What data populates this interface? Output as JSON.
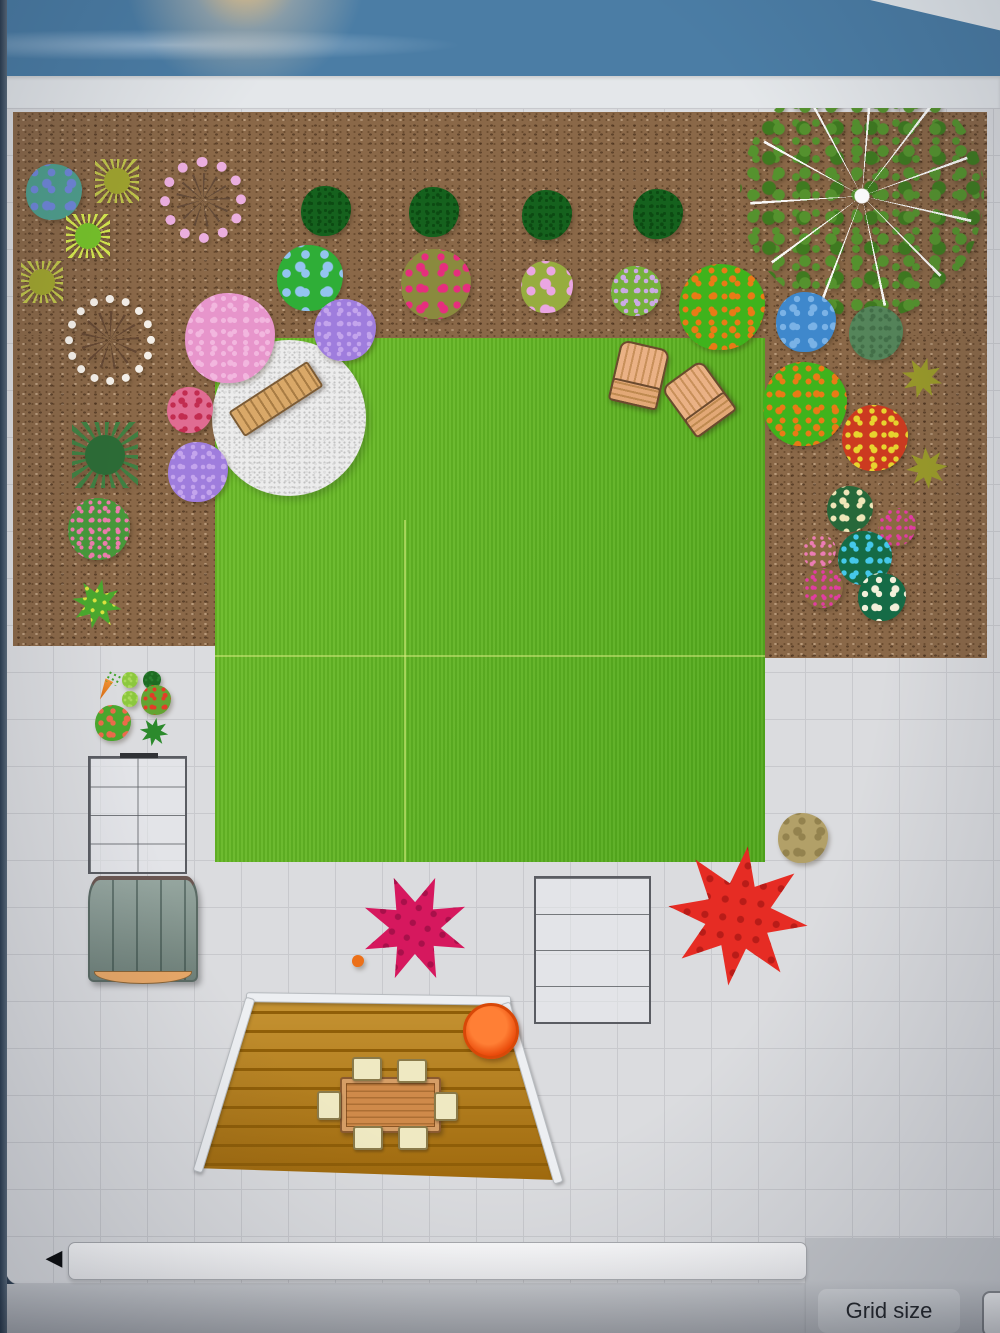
{
  "footer": {
    "grid_size_label": "Grid size",
    "scroll_left_arrow": "◀"
  },
  "garden": {
    "colors": {
      "band_blue": "#4b7da5",
      "band_white": "#e4e7ea",
      "canvas": "#dbdcdf",
      "grid_line": "#c8c9cd",
      "mulch": "#8a6848",
      "lawn": "#5bb51f",
      "gravel": "#ececec",
      "deck": "#b4790f",
      "deck_stripe": "#8f5e08",
      "wood": "#d9a868",
      "chair_cream": "#efe9c2",
      "shed": "#7e928a",
      "bowl": "#f05010",
      "bottom_bar": "#c6c8cc"
    },
    "plants": [
      {
        "name": "blue-berry-bush",
        "shape": "blob",
        "x": 54,
        "y": 192,
        "r": 28,
        "base": "#4f9e8c",
        "dot": "#6f86d8",
        "ds": 17
      },
      {
        "name": "olive-spiky-plant-1",
        "shape": "spike",
        "x": 117,
        "y": 181,
        "r": 22,
        "base": "#a0a42e",
        "tip": "#c0c44a"
      },
      {
        "name": "pink-blossom-wreath",
        "shape": "ring",
        "x": 203,
        "y": 200,
        "r": 52,
        "base": "#5f4736",
        "dot": "#eaaede",
        "bw": 10
      },
      {
        "name": "boxwood-bush-1",
        "shape": "blob",
        "x": 326,
        "y": 211,
        "r": 25,
        "base": "#15611d",
        "dot": "#0c4a12",
        "ds": 7
      },
      {
        "name": "boxwood-bush-2",
        "shape": "blob",
        "x": 434,
        "y": 212,
        "r": 25,
        "base": "#15611d",
        "dot": "#0c4a12",
        "ds": 7
      },
      {
        "name": "boxwood-bush-3",
        "shape": "blob",
        "x": 547,
        "y": 215,
        "r": 25,
        "base": "#15611d",
        "dot": "#0c4a12",
        "ds": 7
      },
      {
        "name": "boxwood-bush-4",
        "shape": "blob",
        "x": 658,
        "y": 214,
        "r": 25,
        "base": "#15611d",
        "dot": "#0c4a12",
        "ds": 7
      },
      {
        "name": "large-tree",
        "shape": "tree",
        "x": 862,
        "y": 196,
        "r": 122,
        "base": "#55922e",
        "dot": "#3f7a20"
      },
      {
        "name": "green-spiky-plant",
        "shape": "spike",
        "x": 88,
        "y": 236,
        "r": 22,
        "base": "#76c22a",
        "tip": "#d6e84e"
      },
      {
        "name": "olive-spiky-plant-2",
        "shape": "spike",
        "x": 42,
        "y": 282,
        "r": 21,
        "base": "#a0a42e",
        "tip": "#c0c44a"
      },
      {
        "name": "blue-flower-plant",
        "shape": "blob",
        "x": 310,
        "y": 278,
        "r": 33,
        "base": "#2fae37",
        "dot": "#93c4ef",
        "ds": 19
      },
      {
        "name": "magenta-flower-plant",
        "shape": "blob",
        "x": 436,
        "y": 284,
        "r": 35,
        "base": "#8a8a3e",
        "dot": "#e62e7e",
        "ds": 16
      },
      {
        "name": "pink-peony-cluster",
        "shape": "blob",
        "x": 547,
        "y": 287,
        "r": 26,
        "base": "#97ad3f",
        "dot": "#eaa6e2",
        "ds": 20
      },
      {
        "name": "lavender-hydrangea",
        "shape": "blob",
        "x": 636,
        "y": 291,
        "r": 25,
        "base": "#76b13a",
        "dot": "#cbaae4",
        "ds": 10
      },
      {
        "name": "orange-berry-bush-1",
        "shape": "blob",
        "x": 722,
        "y": 307,
        "r": 43,
        "base": "#3fb31c",
        "dot": "#e97a16",
        "ds": 13
      },
      {
        "name": "white-blossom-wreath",
        "shape": "ring",
        "x": 110,
        "y": 340,
        "r": 55,
        "base": "#5f4330",
        "dot": "#f4efe8",
        "bw": 8
      },
      {
        "name": "blue-hydrangea",
        "shape": "blob",
        "x": 806,
        "y": 322,
        "r": 30,
        "base": "#3f88cc",
        "dot": "#7ab2e6",
        "ds": 14
      },
      {
        "name": "sage-bush",
        "shape": "blob",
        "x": 876,
        "y": 333,
        "r": 27,
        "base": "#55855a",
        "dot": "#436f48",
        "ds": 9
      },
      {
        "name": "large-pink-bush",
        "shape": "blob",
        "x": 230,
        "y": 338,
        "r": 45,
        "base": "#e795cb",
        "dot": "#f2b6de",
        "ds": 11
      },
      {
        "name": "lilac-flowers-1",
        "shape": "blob",
        "x": 345,
        "y": 330,
        "r": 31,
        "base": "#9f7ddd",
        "dot": "#c3a4ec",
        "ds": 10
      },
      {
        "name": "orange-berry-bush-2",
        "shape": "blob",
        "x": 805,
        "y": 404,
        "r": 42,
        "base": "#3fb31c",
        "dot": "#e97a16",
        "ds": 13
      },
      {
        "name": "olive-maple-plant-1",
        "shape": "star",
        "x": 922,
        "y": 378,
        "r": 23,
        "base": "#99992a",
        "rot": 15
      },
      {
        "name": "red-yellow-coleus",
        "shape": "blob",
        "x": 875,
        "y": 438,
        "r": 33,
        "base": "#cc3a20",
        "dot": "#e8d42e",
        "ds": 12
      },
      {
        "name": "olive-maple-plant-2",
        "shape": "star",
        "x": 927,
        "y": 468,
        "r": 23,
        "base": "#99992a",
        "rot": 40
      },
      {
        "name": "pink-rose-cluster",
        "shape": "blob",
        "x": 190,
        "y": 410,
        "r": 23,
        "base": "#e06c92",
        "dot": "#c22c50",
        "ds": 12
      },
      {
        "name": "conifer-plant",
        "shape": "spike",
        "x": 105,
        "y": 455,
        "r": 33,
        "base": "#2c6b36",
        "tip": "#407f42"
      },
      {
        "name": "lilac-flowers-2",
        "shape": "blob",
        "x": 198,
        "y": 472,
        "r": 30,
        "base": "#9f7ddd",
        "dot": "#c3a4ec",
        "ds": 10
      },
      {
        "name": "pink-dotted-plant",
        "shape": "blob",
        "x": 99,
        "y": 529,
        "r": 31,
        "base": "#47983a",
        "dot": "#ec7cac",
        "ds": 9
      },
      {
        "name": "cream-flower-plant",
        "shape": "blob",
        "x": 850,
        "y": 509,
        "r": 23,
        "base": "#27683a",
        "dot": "#efe6b8",
        "ds": 13
      },
      {
        "name": "magenta-flower-cluster-1",
        "shape": "blob",
        "x": 897,
        "y": 527,
        "r": 19,
        "base": "#8a6a42",
        "dot": "#e23ca2",
        "ds": 8
      },
      {
        "name": "pink-flower-cluster",
        "shape": "blob",
        "x": 819,
        "y": 551,
        "r": 17,
        "base": "#8a6a42",
        "dot": "#ec7cb4",
        "ds": 8
      },
      {
        "name": "blue-flower-cluster",
        "shape": "blob",
        "x": 865,
        "y": 558,
        "r": 27,
        "base": "#156b46",
        "dot": "#45c8ea",
        "ds": 12
      },
      {
        "name": "magenta-flower-cluster-2",
        "shape": "blob",
        "x": 823,
        "y": 588,
        "r": 20,
        "base": "#8a6a42",
        "dot": "#e23ca2",
        "ds": 8
      },
      {
        "name": "white-daisy-cluster",
        "shape": "blob",
        "x": 882,
        "y": 597,
        "r": 24,
        "base": "#156b46",
        "dot": "#f2f0da",
        "ds": 14
      },
      {
        "name": "variegated-ivy",
        "shape": "star",
        "x": 97,
        "y": 604,
        "r": 28,
        "base": "#4aa82e",
        "dot": "#dde33e",
        "ds": 10,
        "rot": 12
      },
      {
        "name": "carrot-icon",
        "shape": "carrot",
        "x": 107,
        "y": 686,
        "r": 15,
        "base": "#e8821e",
        "dot": "#3fa32a"
      },
      {
        "name": "lettuce-plant-1",
        "shape": "blob",
        "x": 130,
        "y": 680,
        "r": 8,
        "base": "#8cc83e",
        "dot": "#aada5c",
        "ds": 6
      },
      {
        "name": "broccoli-plant",
        "shape": "blob",
        "x": 152,
        "y": 680,
        "r": 9,
        "base": "#1d6b22",
        "dot": "#2a8030",
        "ds": 6
      },
      {
        "name": "lettuce-plant-2",
        "shape": "blob",
        "x": 130,
        "y": 699,
        "r": 8,
        "base": "#8cc83e",
        "dot": "#aada5c",
        "ds": 6
      },
      {
        "name": "tomato-plant",
        "shape": "blob",
        "x": 156,
        "y": 700,
        "r": 15,
        "base": "#63a432",
        "dot": "#e23c28",
        "ds": 9
      },
      {
        "name": "strawberry-plant",
        "shape": "blob",
        "x": 113,
        "y": 723,
        "r": 18,
        "base": "#4aa82e",
        "dot": "#ec6a4a",
        "ds": 12
      },
      {
        "name": "zucchini-plant",
        "shape": "star",
        "x": 154,
        "y": 732,
        "r": 16,
        "base": "#2c8a2c",
        "rot": 10
      },
      {
        "name": "crimson-maple-bush",
        "shape": "star",
        "x": 415,
        "y": 928,
        "r": 60,
        "base": "#d6185e",
        "dot": "#a8104a",
        "ds": 16,
        "rot": 22
      },
      {
        "name": "orange-ball-accent",
        "shape": "blob",
        "x": 358,
        "y": 961,
        "r": 6,
        "base": "#ec7018",
        "dot": "#ec7018",
        "ds": 6
      },
      {
        "name": "red-maple-bush",
        "shape": "star",
        "x": 738,
        "y": 916,
        "r": 78,
        "base": "#e62c24",
        "dot": "#b81c18",
        "ds": 18,
        "rot": 8
      },
      {
        "name": "garden-rock",
        "shape": "blob",
        "x": 803,
        "y": 838,
        "r": 25,
        "base": "#b2a068",
        "dot": "#93824e",
        "ds": 16
      }
    ]
  }
}
